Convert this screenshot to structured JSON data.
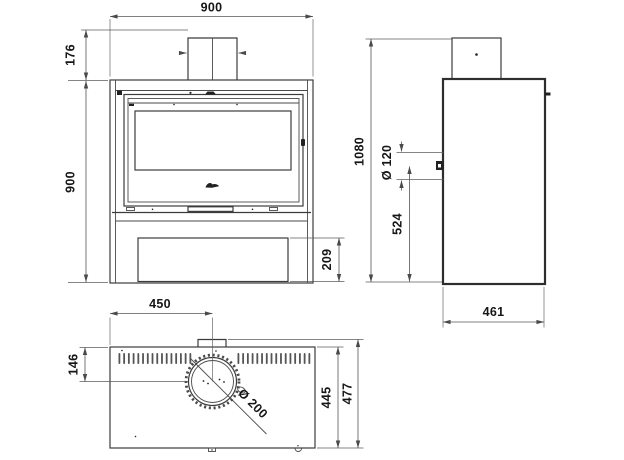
{
  "style": {
    "background": "#ffffff",
    "line_color": "#3c3c3c",
    "dimension_text_color": "#161616"
  },
  "drawing": {
    "front_view": {
      "width_mm": "900",
      "flue_section_height_mm": "176",
      "body_height_mm": "900",
      "log_store_height_mm": "209"
    },
    "side_view": {
      "total_height_mm": "1080",
      "rear_flue_diameter": "Ø 120",
      "rear_flue_height_mm": "524",
      "depth_mm": "461"
    },
    "top_view": {
      "flue_center_from_left_mm": "450",
      "flue_center_from_front_mm": "146",
      "body_depth_mm": "445",
      "overall_depth_mm": "477",
      "flue_collar_diameter": "Ø 200"
    }
  }
}
